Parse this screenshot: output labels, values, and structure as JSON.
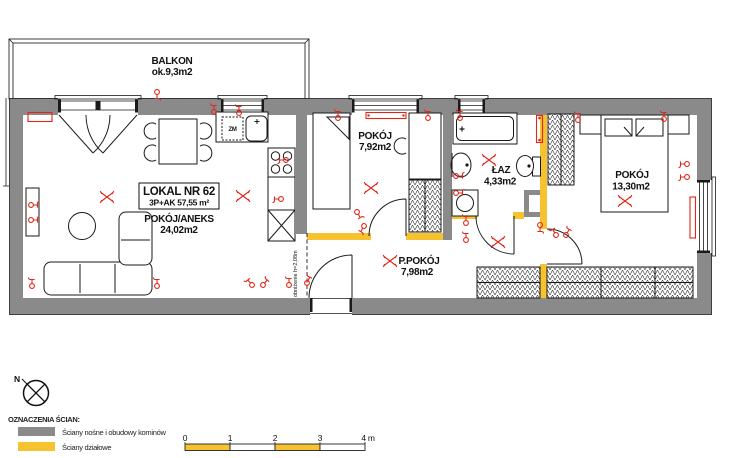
{
  "plan": {
    "title_block": {
      "line1": "LOKAL NR 62",
      "line2": "3P+AK 57,55 m²"
    },
    "rooms": [
      {
        "id": "balkon",
        "name": "BALKON",
        "area": "ok.9,3m2"
      },
      {
        "id": "pokoj-aneks",
        "name": "POKÓJ/ANEKS",
        "area": "24,02m2"
      },
      {
        "id": "pokoj-maly",
        "name": "POKÓJ",
        "area": "7,92m2"
      },
      {
        "id": "lazienka",
        "name": "ŁAZ",
        "area": "4,33m2"
      },
      {
        "id": "przedpokoj",
        "name": "P.POKÓJ",
        "area": "7,98m2"
      },
      {
        "id": "sypialnia",
        "name": "POKÓJ",
        "area": "13,30m2"
      }
    ],
    "annotations": {
      "lowered_ceiling": "obniżenie h=2,08m",
      "dishwasher_label": "ZM"
    }
  },
  "legend": {
    "north_label": "N",
    "title": "OZNACZENIA ŚCIAN:",
    "items": [
      {
        "label": "Ściany nośne i obudowy kominów",
        "color": "#8a8a8a"
      },
      {
        "label": "Ściany działowe",
        "color": "#f6c230"
      }
    ],
    "scale_bar": {
      "ticks": [
        "0",
        "1",
        "2",
        "3"
      ],
      "end_label": "4 m"
    }
  },
  "colors": {
    "gray": "#8a8a8a",
    "yellow": "#f6c230",
    "red": "#e02619"
  }
}
